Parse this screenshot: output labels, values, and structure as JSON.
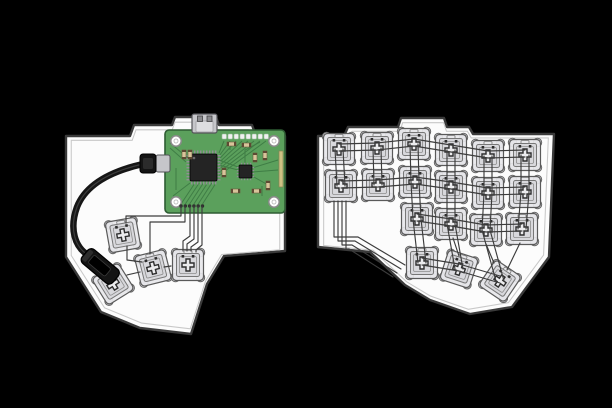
{
  "scene": {
    "width": 612,
    "height": 408,
    "background": "#000000",
    "description": "split ergonomic keyboard hand-wiring illustration, left half with controller PCB and USB cable, right half fully populated switch matrix"
  },
  "colors": {
    "plate_fill": "#fcfcfc",
    "plate_stroke": "#3a3a3a",
    "plate_inner_stroke": "#c8c8c8",
    "switch_body": "#e7e7ea",
    "switch_inner": "#d8d8dc",
    "switch_stroke": "#5a5a5a",
    "switch_post": "#cfcfd3",
    "stem_fill": "#ececee",
    "stem_stroke": "#2e2e2e",
    "wire": "#3c3c3c",
    "pin_dot": "#2d2d2d",
    "pcb_fill": "#5ba05c",
    "pcb_stroke": "#2e5c33",
    "pcb_trace": "#3f7d45",
    "chip_fill": "#242424",
    "chip_pin": "#909094",
    "hole_ring": "#8a8a8a",
    "passive_fill": "#d8c49a",
    "passive_end": "#5d4a33",
    "usb_metal": "#c6c6ca",
    "usb_metal_dark": "#8a8a8e",
    "cable": "#161616",
    "plug_fill": "#141414",
    "gold": "#cdc183"
  },
  "left_half": {
    "plate_path": "M66,136 L130,136 L134,125 L172,125 L175,117 L216,117 L219,125 L252,125 L256,136 L285,136 L285,251 L224,256 L207,284 L191,334 L140,328 L101,312 L66,257 Z",
    "pcb": {
      "x": 165,
      "y": 130,
      "w": 120,
      "h": 83
    },
    "switches": [
      {
        "x": 123,
        "y": 235,
        "rot": -10
      },
      {
        "x": 153,
        "y": 268,
        "rot": -14
      },
      {
        "x": 113,
        "y": 284,
        "rot": -32
      },
      {
        "x": 188,
        "y": 265,
        "rot": 0
      }
    ],
    "chain_wires": [
      "M127,246 L127,260 L142,262",
      "M140,272 L127,275",
      "M171,266 L164,267"
    ],
    "pcb_wires": [
      "M181,206 L181,216 L126,216 L126,223",
      "M185,206 L185,222 L150,222 L150,254",
      "M190,206 L190,236 L183,241 L183,251",
      "M194,206 L194,239 L187,244 L187,251",
      "M198,206 L198,242 L191,247 L191,251",
      "M202,206 L202,245 L196,250 L196,252"
    ],
    "cable_path": "M143,164 C112,171 86,184 77,207 C69,229 75,247 88,255 L93,259",
    "plug_end": {
      "x": 101,
      "y": 267,
      "rot": 40
    },
    "plug_pcb": {
      "x": 140,
      "y": 154
    }
  },
  "right_half": {
    "plate_path": "M318,136 L344,136 L348,127 L398,127 L401,118 L444,118 L447,127 L469,127 L473,134 L554,134 L549,257 L512,307 L470,314 L430,300 L405,285 L370,252 L318,247 Z",
    "switches": [
      {
        "row": 0,
        "col": 0,
        "x": 339,
        "y": 149,
        "rot": 0
      },
      {
        "row": 0,
        "col": 1,
        "x": 377,
        "y": 148,
        "rot": 0
      },
      {
        "row": 0,
        "col": 2,
        "x": 414,
        "y": 144,
        "rot": 0
      },
      {
        "row": 0,
        "col": 3,
        "x": 451,
        "y": 150,
        "rot": 0
      },
      {
        "row": 0,
        "col": 4,
        "x": 488,
        "y": 156,
        "rot": 0
      },
      {
        "row": 0,
        "col": 5,
        "x": 525,
        "y": 155,
        "rot": 0
      },
      {
        "row": 1,
        "col": 0,
        "x": 341,
        "y": 186,
        "rot": 0
      },
      {
        "row": 1,
        "col": 1,
        "x": 378,
        "y": 185,
        "rot": 0
      },
      {
        "row": 1,
        "col": 2,
        "x": 415,
        "y": 182,
        "rot": 0
      },
      {
        "row": 1,
        "col": 3,
        "x": 451,
        "y": 187,
        "rot": 0
      },
      {
        "row": 1,
        "col": 4,
        "x": 488,
        "y": 193,
        "rot": 0
      },
      {
        "row": 1,
        "col": 5,
        "x": 525,
        "y": 192,
        "rot": 0
      },
      {
        "row": 2,
        "col": 2,
        "x": 417,
        "y": 219,
        "rot": 0
      },
      {
        "row": 2,
        "col": 3,
        "x": 451,
        "y": 224,
        "rot": 0
      },
      {
        "row": 2,
        "col": 4,
        "x": 486,
        "y": 230,
        "rot": 0
      },
      {
        "row": 2,
        "col": 5,
        "x": 522,
        "y": 229,
        "rot": 0
      },
      {
        "row": 3,
        "col": 2,
        "x": 422,
        "y": 263,
        "rot": 0
      },
      {
        "row": 3,
        "col": 3,
        "x": 459,
        "y": 269,
        "rot": 18
      },
      {
        "row": 3,
        "col": 4,
        "x": 500,
        "y": 281,
        "rot": 34
      }
    ],
    "extra_wires": [
      "M334,201 L334,237 L358,237 L405,265",
      "M338,201 L338,241 L355,241 L401,269",
      "M342,201 L342,245 L352,245 L397,273",
      "M346,201 L346,249 L349,249 L393,277",
      "M453,238 L459,256",
      "M520,243 L507,270",
      "M486,244 L494,263"
    ]
  }
}
